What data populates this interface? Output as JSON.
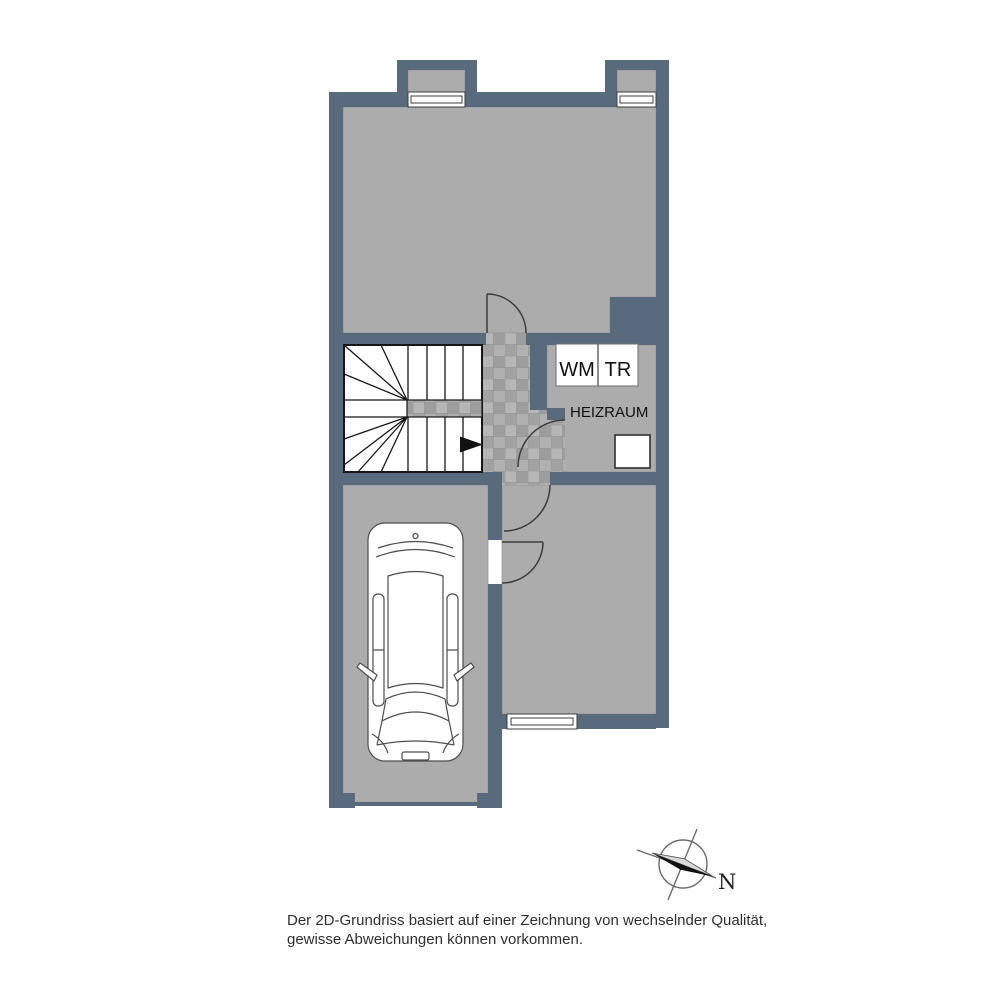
{
  "floorplan": {
    "appliances": {
      "washing_machine": "WM",
      "dryer": "TR"
    },
    "rooms": {
      "boiler_room": "HEIZRAUM"
    },
    "compass": {
      "north": "N"
    },
    "disclaimer": {
      "line1": "Der 2D-Grundriss basiert auf einer Zeichnung von wechselnder Qualität,",
      "line2": "gewisse Abweichungen können vorkommen."
    },
    "colors": {
      "wall": "#5a6a7d",
      "floor": "#acacac",
      "tile": "#a9a9a9",
      "background": "#ffffff"
    }
  }
}
